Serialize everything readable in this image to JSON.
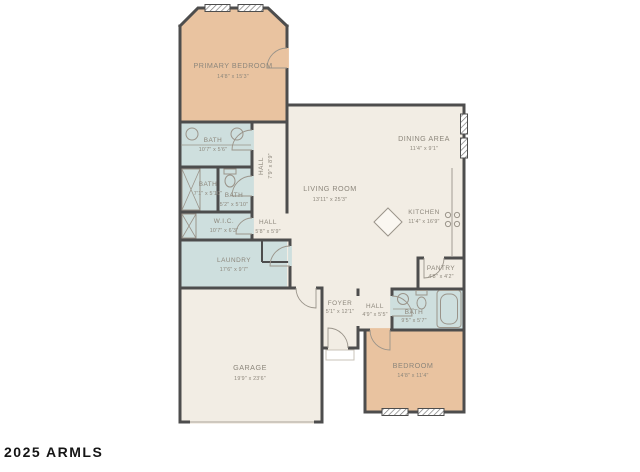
{
  "watermark": "2025 ARMLS",
  "colors": {
    "room_cream": "#f2ede4",
    "room_tan": "#e9c3a0",
    "room_blue": "#cedfde",
    "wall": "#4d4d4d",
    "label_text": "#8c867b",
    "watermark_text": "#151515"
  },
  "rooms": [
    {
      "id": "primary-bedroom",
      "name": "PRIMARY BEDROOM",
      "dims": "14'8\" x 15'3\""
    },
    {
      "id": "bath-primary",
      "name": "BATH",
      "dims": "10'7\" x 5'6\""
    },
    {
      "id": "hall-upper",
      "name": "HALL",
      "dims": "7'9\" x 8'9\""
    },
    {
      "id": "bath-2",
      "name": "BATH",
      "dims": "7'1\" x 5'10\""
    },
    {
      "id": "bath-3",
      "name": "BATH",
      "dims": "5'2\" x 5'10\""
    },
    {
      "id": "wic",
      "name": "W.I.C.",
      "dims": "10'7\" x 6'3\""
    },
    {
      "id": "hall-mid",
      "name": "HALL",
      "dims": "5'8\" x 5'9\""
    },
    {
      "id": "laundry",
      "name": "LAUNDRY",
      "dims": "17'6\" x 9'7\""
    },
    {
      "id": "living-room",
      "name": "LIVING ROOM",
      "dims": "13'11\" x 25'3\""
    },
    {
      "id": "dining-area",
      "name": "DINING AREA",
      "dims": "11'4\" x 9'1\""
    },
    {
      "id": "kitchen",
      "name": "KITCHEN",
      "dims": "11'4\" x 16'9\""
    },
    {
      "id": "pantry",
      "name": "PANTRY",
      "dims": "4'8\" x 4'2\""
    },
    {
      "id": "foyer",
      "name": "FOYER",
      "dims": "5'1\" x 12'1\""
    },
    {
      "id": "hall-lower",
      "name": "HALL",
      "dims": "4'9\" x 5'5\""
    },
    {
      "id": "bath-lower",
      "name": "BATH",
      "dims": "9'5\" x 5'7\""
    },
    {
      "id": "bedroom-2",
      "name": "BEDROOM",
      "dims": "14'8\" x 11'4\""
    },
    {
      "id": "garage",
      "name": "GARAGE",
      "dims": "19'9\" x 23'6\""
    }
  ]
}
